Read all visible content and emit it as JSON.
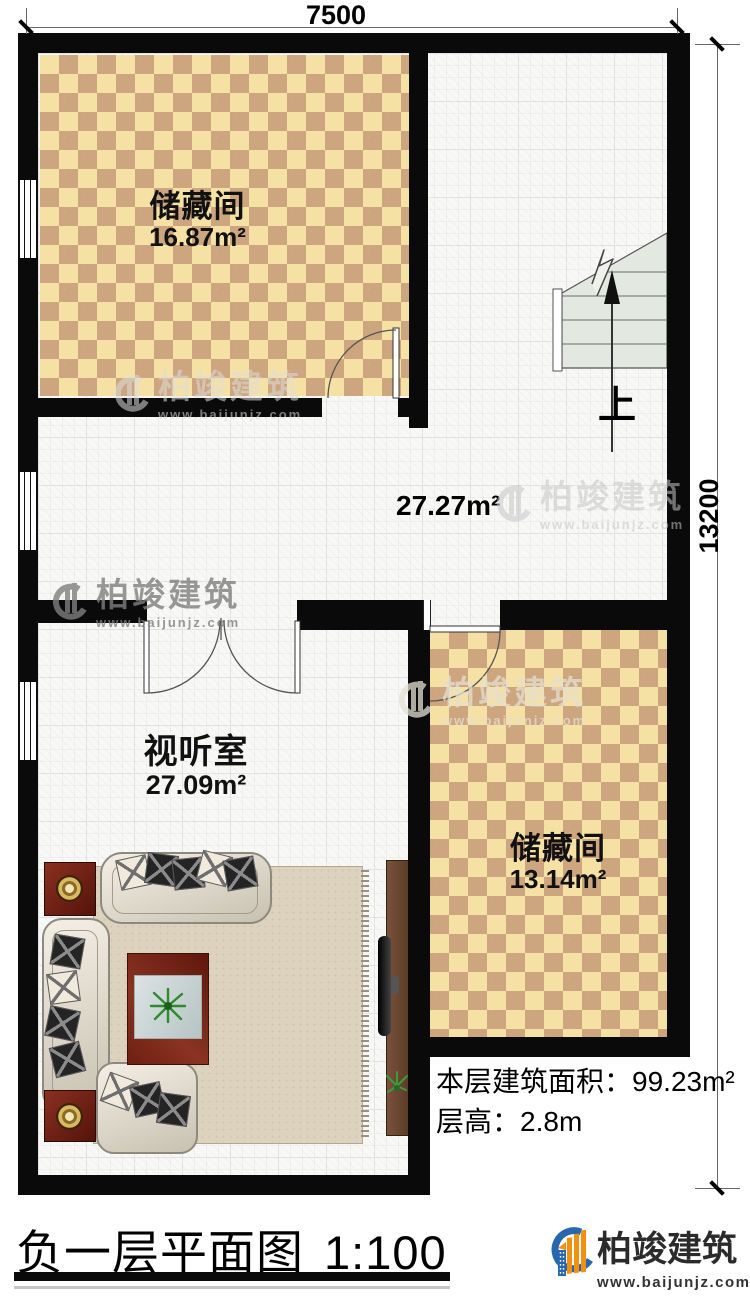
{
  "dimensions": {
    "top": "7500",
    "right": "13200"
  },
  "rooms": {
    "storage1": {
      "name": "储藏间",
      "area": "16.87m²"
    },
    "hall": {
      "area": "27.27m²"
    },
    "av_room": {
      "name": "视听室",
      "area": "27.09m²"
    },
    "storage2": {
      "name": "储藏间",
      "area": "13.14m²"
    }
  },
  "stairs": {
    "direction_label": "上"
  },
  "summary": {
    "floor_area_label": "本层建筑面积：",
    "floor_area_value": "99.23m²",
    "floor_height_label": "层高：",
    "floor_height_value": "2.8m"
  },
  "title_block": {
    "title": "负一层平面图",
    "scale": "1:100"
  },
  "brand": {
    "name": "柏竣建筑",
    "website": "www.baijunjz.com"
  },
  "watermark": {
    "name": "柏竣建筑",
    "website": "www.baijunjz.com"
  },
  "colors": {
    "wall": "#0a0a0a",
    "checker_light": "#f6e1a4",
    "checker_dark": "#cda57f",
    "stair_fill": "#e3e8e1",
    "brand_blue": "#2767B0",
    "brand_orange": "#F29111"
  }
}
